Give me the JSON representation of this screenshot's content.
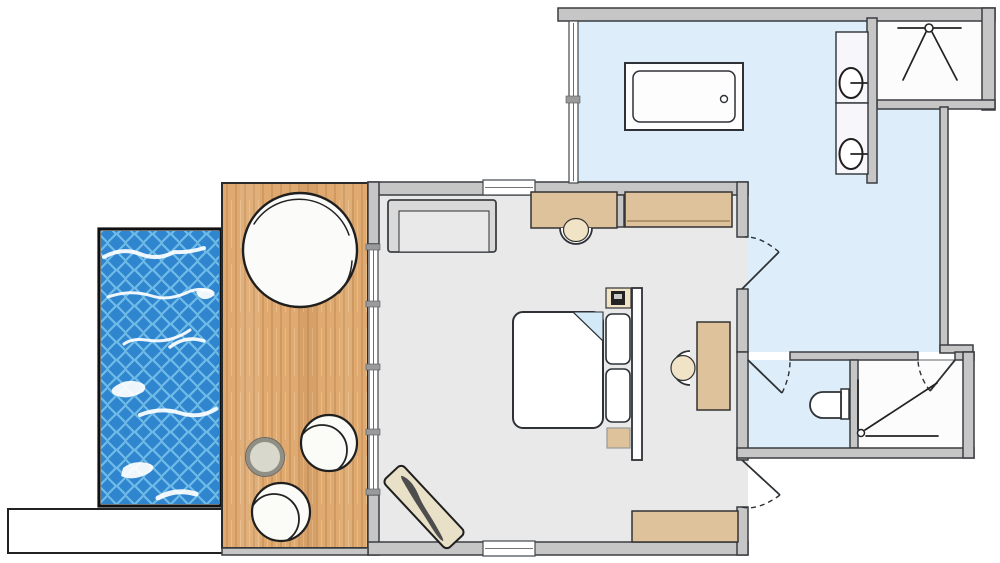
{
  "meta": {
    "kind": "architectural-floor-plan",
    "title": "Hotel suite floor plan with plunge pool"
  },
  "palette": {
    "background": "#ffffff",
    "wall_fill": "#c6c6c6",
    "wall_line": "#3a3d40",
    "bedroom_floor": "#e9e9e9",
    "bathroom_floor": "#ddeefa",
    "deck_wood": "#dfa96f",
    "deck_wood_grain": "#8c5a26",
    "pool_water": "#2f86cf",
    "pool_tile_line": "#6fbbe8",
    "pool_reflection": "#ffffff",
    "furniture_tan": "#ddc29c",
    "furniture_pale": "#f0e3c6",
    "sofa_gray": "#d9d9d9",
    "duvet_fold_blue": "#d3e9f7",
    "chaise_pad": "#e9e0c8",
    "chaise_dark": "#4d4d4d",
    "table_gray": "#d9d8cc"
  },
  "rooms": [
    {
      "id": "plunge-pool",
      "label": "plunge pool"
    },
    {
      "id": "sun-deck",
      "label": "sun deck / terrace"
    },
    {
      "id": "bedroom",
      "label": "bedroom"
    },
    {
      "id": "bathroom",
      "label": "bathroom"
    },
    {
      "id": "walk-in-shower",
      "label": "walk-in shower"
    },
    {
      "id": "wc",
      "label": "wc"
    },
    {
      "id": "shower-room",
      "label": "shower room"
    }
  ],
  "symbols": [
    {
      "id": "round-daybed",
      "label": "round daybed"
    },
    {
      "id": "papasan-chair",
      "label": "round lounge chair"
    },
    {
      "id": "side-table",
      "label": "side table"
    },
    {
      "id": "chaise-longue",
      "label": "chaise longue"
    },
    {
      "id": "sofa",
      "label": "sofa"
    },
    {
      "id": "desk",
      "label": "desk / console"
    },
    {
      "id": "desk-chair",
      "label": "desk chair"
    },
    {
      "id": "wardrobe",
      "label": "wardrobe"
    },
    {
      "id": "double-bed",
      "label": "double bed with folded duvet"
    },
    {
      "id": "nightstand",
      "label": "nightstand"
    },
    {
      "id": "writing-desk",
      "label": "writing desk"
    },
    {
      "id": "luggage-bench",
      "label": "luggage bench"
    },
    {
      "id": "bathtub",
      "label": "bathtub"
    },
    {
      "id": "vanity-sink",
      "label": "vanity sink"
    },
    {
      "id": "shower-head-symbol",
      "label": "shower spray symbol"
    },
    {
      "id": "toilet",
      "label": "toilet"
    },
    {
      "id": "door-swing",
      "label": "door with swing arc"
    },
    {
      "id": "window",
      "label": "window / glazing"
    }
  ]
}
